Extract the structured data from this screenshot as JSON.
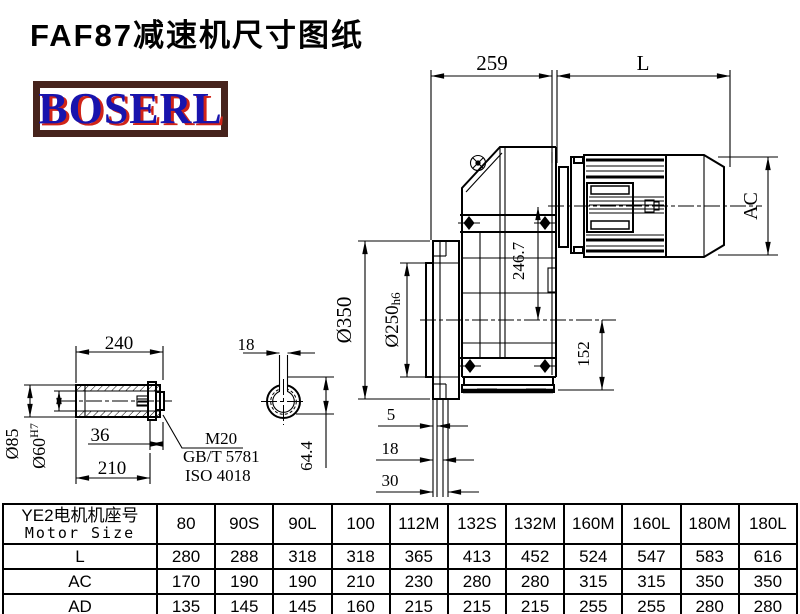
{
  "page": {
    "title": "FAF87减速机尺寸图纸"
  },
  "logo": {
    "text": "BOSERL",
    "border_color": "#46231c",
    "text_color": "#1813ad",
    "shadow_color": "#d02418"
  },
  "drawing": {
    "dim_259": "259",
    "dim_L": "L",
    "dim_AC": "AC",
    "dim_246_7": "246.7",
    "dim_152": "152",
    "dim_350": "Ø350",
    "dim_250": "Ø250",
    "dim_250_tol": "h6",
    "dim_5": "5",
    "dim_18b": "18",
    "dim_30": "30",
    "shaft": {
      "dim_240": "240",
      "dim_85": "Ø85",
      "dim_60": "Ø60",
      "dim_60_tol": "H7",
      "dim_36": "36",
      "dim_210": "210",
      "callout_1": "M20",
      "callout_2": "GB/T 5781",
      "callout_3": "ISO 4018",
      "dim_18": "18",
      "dim_64_4": "64.4"
    }
  },
  "table": {
    "header_cn": "YE2电机机座号",
    "header_en": "Motor Size",
    "columns": [
      "80",
      "90S",
      "90L",
      "100",
      "112M",
      "132S",
      "132M",
      "160M",
      "160L",
      "180M",
      "180L"
    ],
    "rows": [
      {
        "label": "L",
        "values": [
          "280",
          "288",
          "318",
          "318",
          "365",
          "413",
          "452",
          "524",
          "547",
          "583",
          "616"
        ]
      },
      {
        "label": "AC",
        "values": [
          "170",
          "190",
          "190",
          "210",
          "230",
          "280",
          "280",
          "315",
          "315",
          "350",
          "350"
        ]
      },
      {
        "label": "AD",
        "values": [
          "135",
          "145",
          "145",
          "160",
          "215",
          "215",
          "215",
          "255",
          "255",
          "280",
          "280"
        ]
      }
    ]
  }
}
